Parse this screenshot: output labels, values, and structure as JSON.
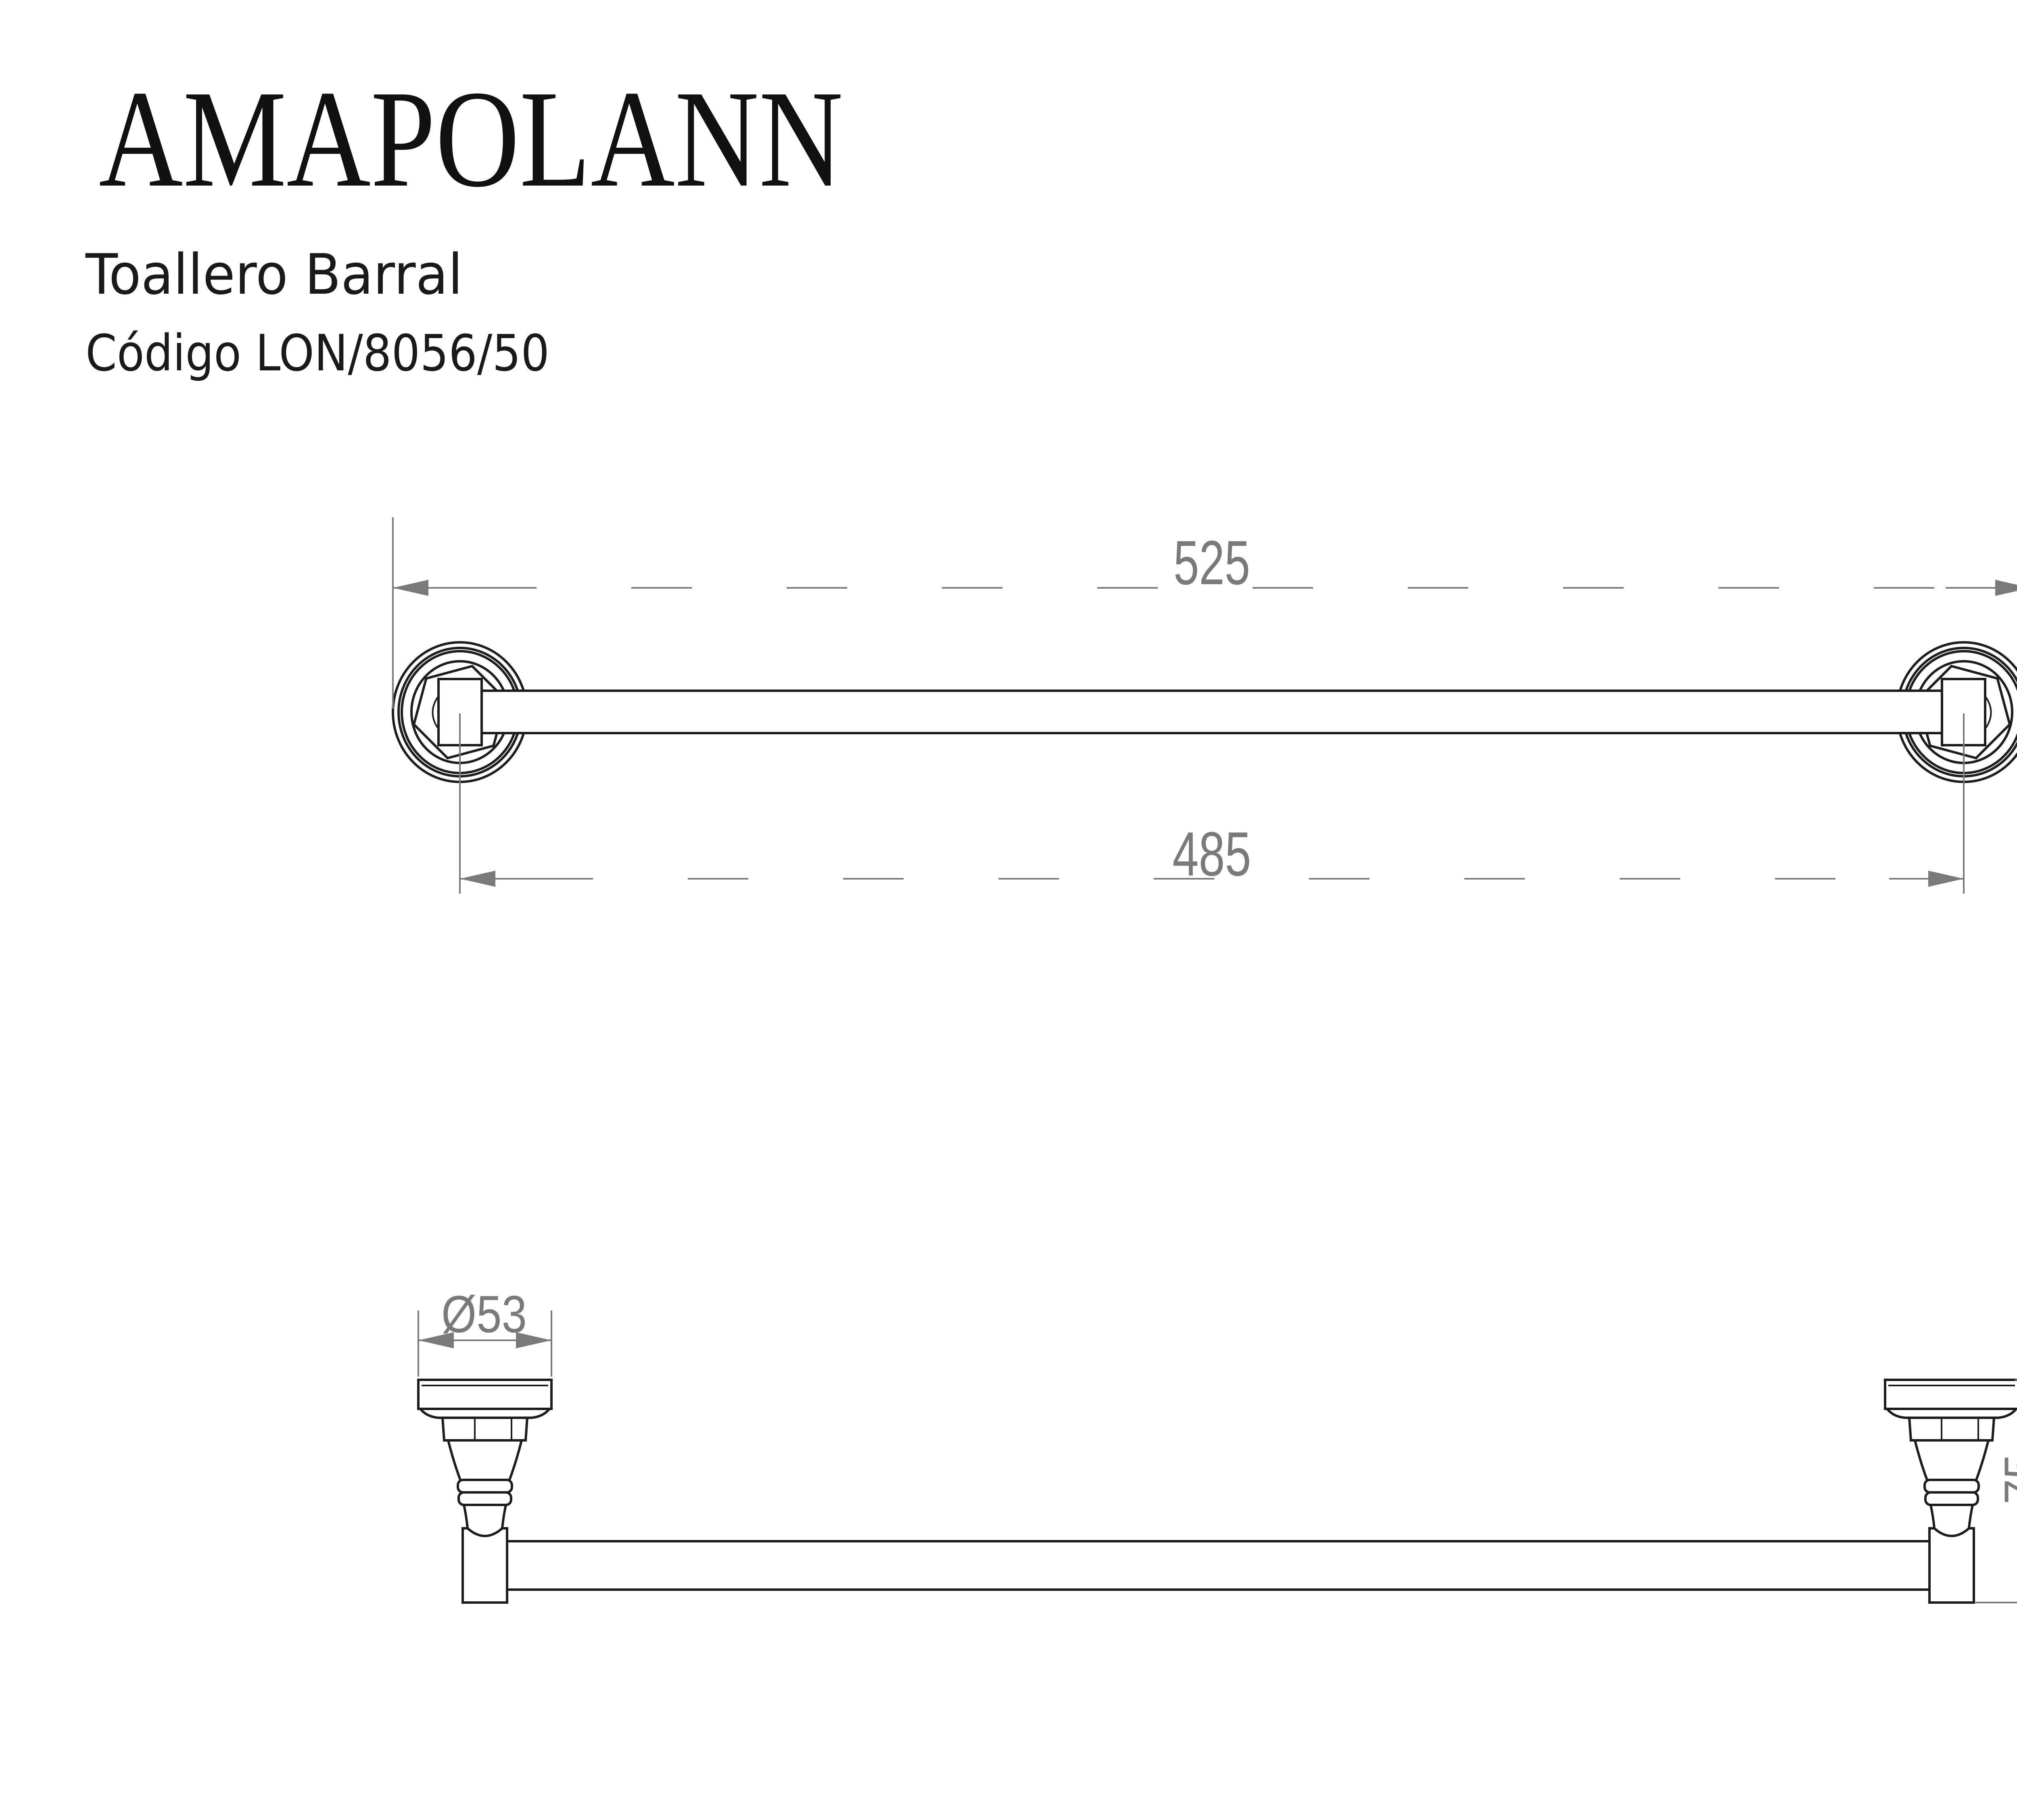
{
  "header": {
    "brand": "AMAPOLANN",
    "product": "Toallero Barral",
    "code": "Código LON/8056/50"
  },
  "notes": {
    "units_line1": "Medidas en mm.",
    "units_line2": "(milimetros)"
  },
  "dimensions": {
    "front_total_width": "525",
    "front_center_distance": "485",
    "rosette_diameter": "Ø53",
    "bracket_height": "75"
  },
  "colors": {
    "line": "#1d1d1d",
    "dimension": "#7a7a7a",
    "background": "#ffffff"
  }
}
